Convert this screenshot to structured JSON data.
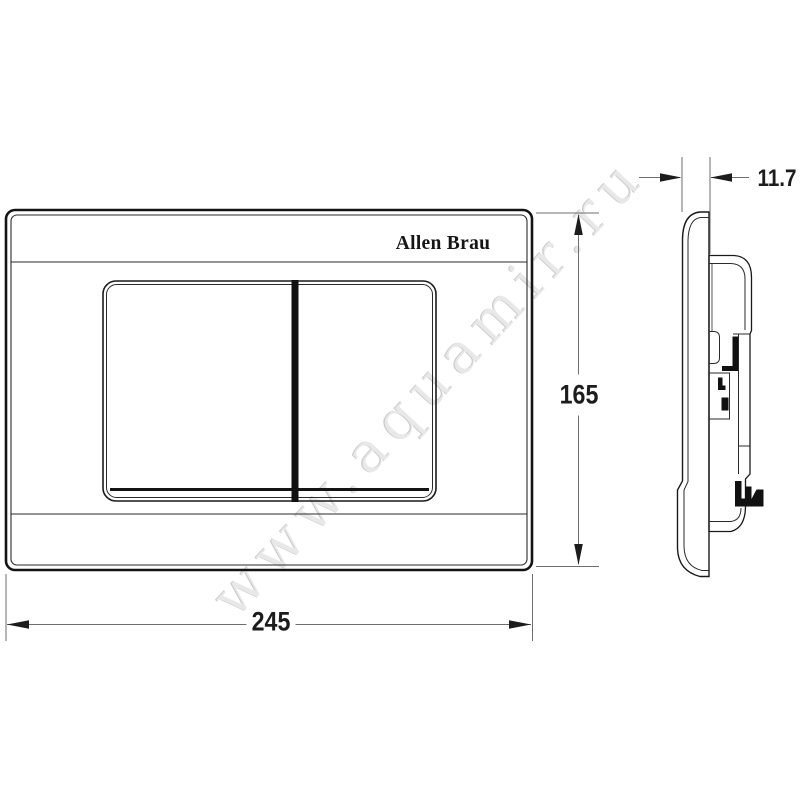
{
  "watermark": {
    "text": "www.aquamir.ru"
  },
  "brand": {
    "logo": "Allen Brau"
  },
  "dimensions": {
    "width": "245",
    "height": "165",
    "thickness": "11.7"
  },
  "colors": {
    "background": "#ffffff",
    "outline": "#1a1a1a",
    "thin_line": "#2a2a2a",
    "dimension_line": "#6e6e6e",
    "arrow": "#1c1c1c",
    "solid_black_detail": "#111111",
    "watermark_gray": "#cccccc"
  }
}
